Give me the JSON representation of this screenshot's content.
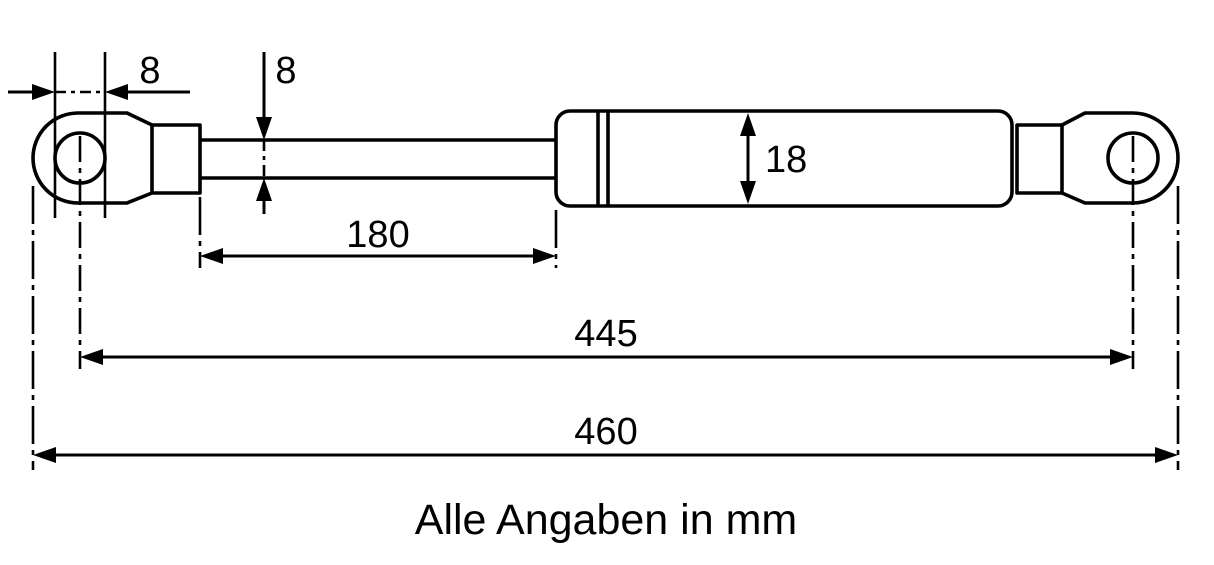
{
  "drawing": {
    "note": "Alle Angaben in mm",
    "dimensions": {
      "eye_hole_diameter": "8",
      "rod_diameter": "8",
      "cylinder_diameter": "18",
      "rod_length": "180",
      "eye_center_to_center": "445",
      "overall_length": "460"
    }
  }
}
